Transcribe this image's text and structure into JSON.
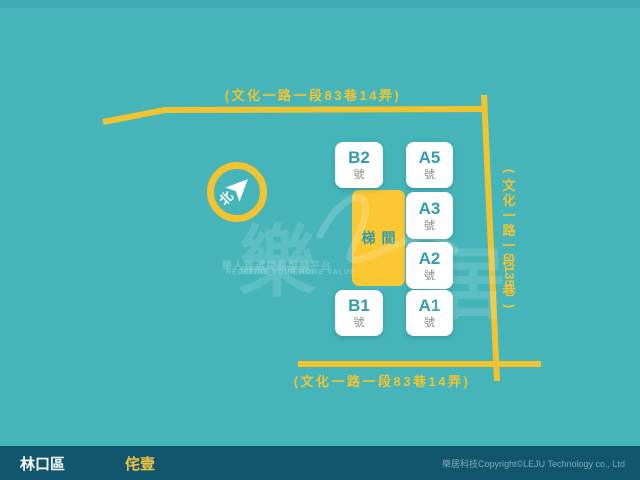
{
  "colors": {
    "background": "#45b5ba",
    "road_yellow": "#f3c32f",
    "box_white": "#ffffff",
    "unit_text_teal": "#2f9dab",
    "unit_suffix_gray": "#8d8d85",
    "stairwell_fill": "#fbc733",
    "footer_bg": "#11566c",
    "footer_building_yellow": "#f0c43e",
    "footer_copyright": "#7fa9b9"
  },
  "roads": {
    "top_label": "(文化一路一段83巷14弄)",
    "bottom_label": "(文化一路一段83巷14弄)",
    "right_label": "(文化一路一段135巷)",
    "right_label_chars": [
      "(",
      "文",
      "化",
      "一",
      "路",
      "一",
      "段",
      "135",
      "巷",
      ")"
    ]
  },
  "compass": {
    "north_label": "北"
  },
  "site": {
    "stairwell_label": "梯間",
    "units": [
      {
        "name": "B2",
        "suffix": "號"
      },
      {
        "name": "A5",
        "suffix": "號"
      },
      {
        "name": "A3",
        "suffix": "號"
      },
      {
        "name": "A2",
        "suffix": "號"
      },
      {
        "name": "B1",
        "suffix": "號"
      },
      {
        "name": "A1",
        "suffix": "號"
      }
    ]
  },
  "watermark": {
    "char_left": "樂",
    "char_right": "居",
    "line1": "華人首選房產服務平台",
    "line2": "REDEFINE YOUR HOME VALUE"
  },
  "footer": {
    "district": "林口區",
    "building": "侘壹",
    "copyright": "樂居科技Copyright©LEJU Technology co., Ltd"
  }
}
